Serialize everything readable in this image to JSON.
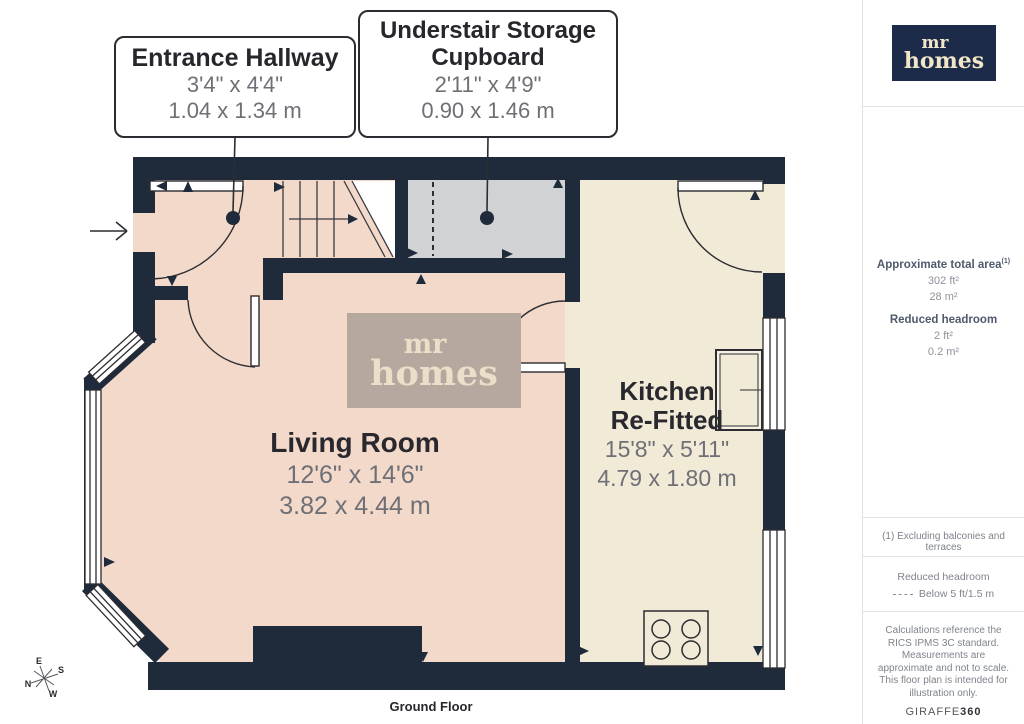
{
  "plan": {
    "callouts": [
      {
        "title": "Entrance Hallway",
        "dims_imperial": "3'4\" x 4'4\"",
        "dims_metric": "1.04 x 1.34 m"
      },
      {
        "title": "Understair Storage Cupboard",
        "dims_imperial": "2'11\" x 4'9\"",
        "dims_metric": "0.90 x 1.46 m"
      }
    ],
    "rooms": [
      {
        "name": "Living Room",
        "dims_imperial": "12'6\" x 14'6\"",
        "dims_metric": "3.82 x 4.44 m"
      },
      {
        "name_line1": "Kitchen",
        "name_line2": "Re-Fitted",
        "dims_imperial": "15'8\" x 5'11\"",
        "dims_metric": "4.79 x 1.80 m"
      }
    ],
    "watermark": {
      "line1": "mr",
      "line2": "homes"
    },
    "compass": {
      "n": "N",
      "e": "E",
      "s": "S",
      "w": "W"
    },
    "floor_label": "Ground Floor"
  },
  "sidebar": {
    "logo": {
      "line1": "mr",
      "line2": "homes"
    },
    "area": {
      "heading": "Approximate total area",
      "sup": "(1)",
      "imperial": "302 ft²",
      "metric": "28 m²"
    },
    "headroom": {
      "heading": "Reduced headroom",
      "imperial": "2 ft²",
      "metric": "0.2 m²"
    },
    "footnote": "(1) Excluding balconies and terraces",
    "legend": {
      "title": "Reduced headroom",
      "label": "Below 5 ft/1.5 m"
    },
    "disclaimer": "Calculations reference the RICS IPMS 3C standard. Measurements are approximate and not to scale. This floor plan is intended for illustration only.",
    "brand": {
      "name": "GIRAFFE",
      "suffix": "360"
    }
  },
  "colors": {
    "wall": "#1f2b3b",
    "floor_pink": "#f3d9ca",
    "floor_cream": "#f0ead7",
    "floor_gray": "#d1d2d4",
    "watermark_bg": "#b7a89f",
    "logo_bg": "#1c2b49",
    "logo_text": "#f2e6c9"
  }
}
